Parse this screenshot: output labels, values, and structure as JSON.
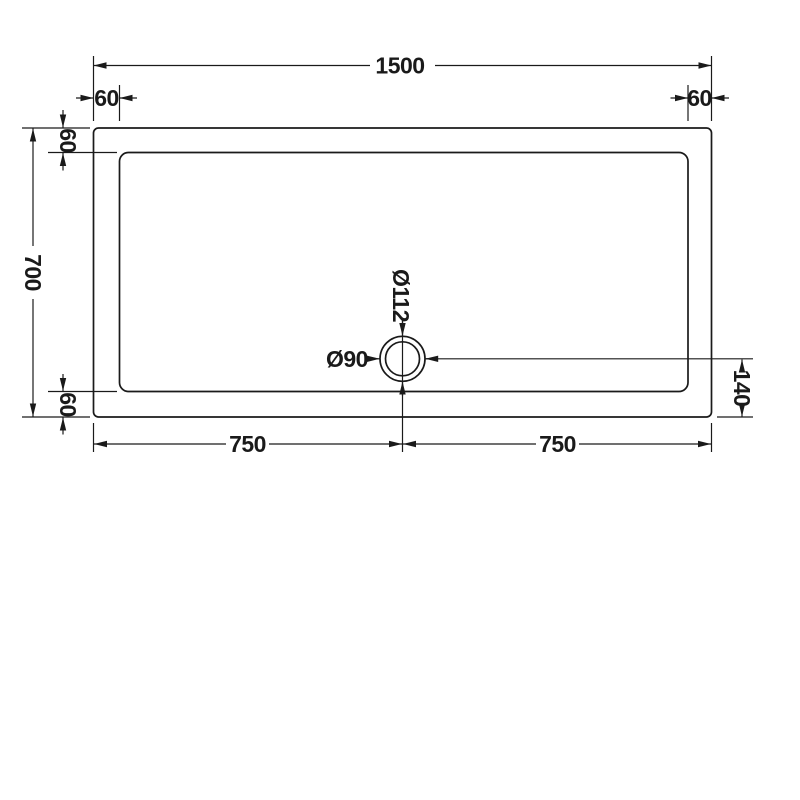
{
  "drawing": {
    "line_color": "#1a1a1a",
    "background_color": "#ffffff",
    "dimensions": {
      "overall_width": "1500",
      "overall_depth": "700",
      "corner_inset_top_left": "60",
      "corner_inset_top_right": "60",
      "edge_inset_left_top": "60",
      "edge_inset_left_bottom": "60",
      "half_width_left": "750",
      "half_width_right": "750",
      "drain_center_from_bottom": "140",
      "drain_outer_diameter": "Ø112",
      "drain_inner_diameter": "Ø90"
    }
  }
}
